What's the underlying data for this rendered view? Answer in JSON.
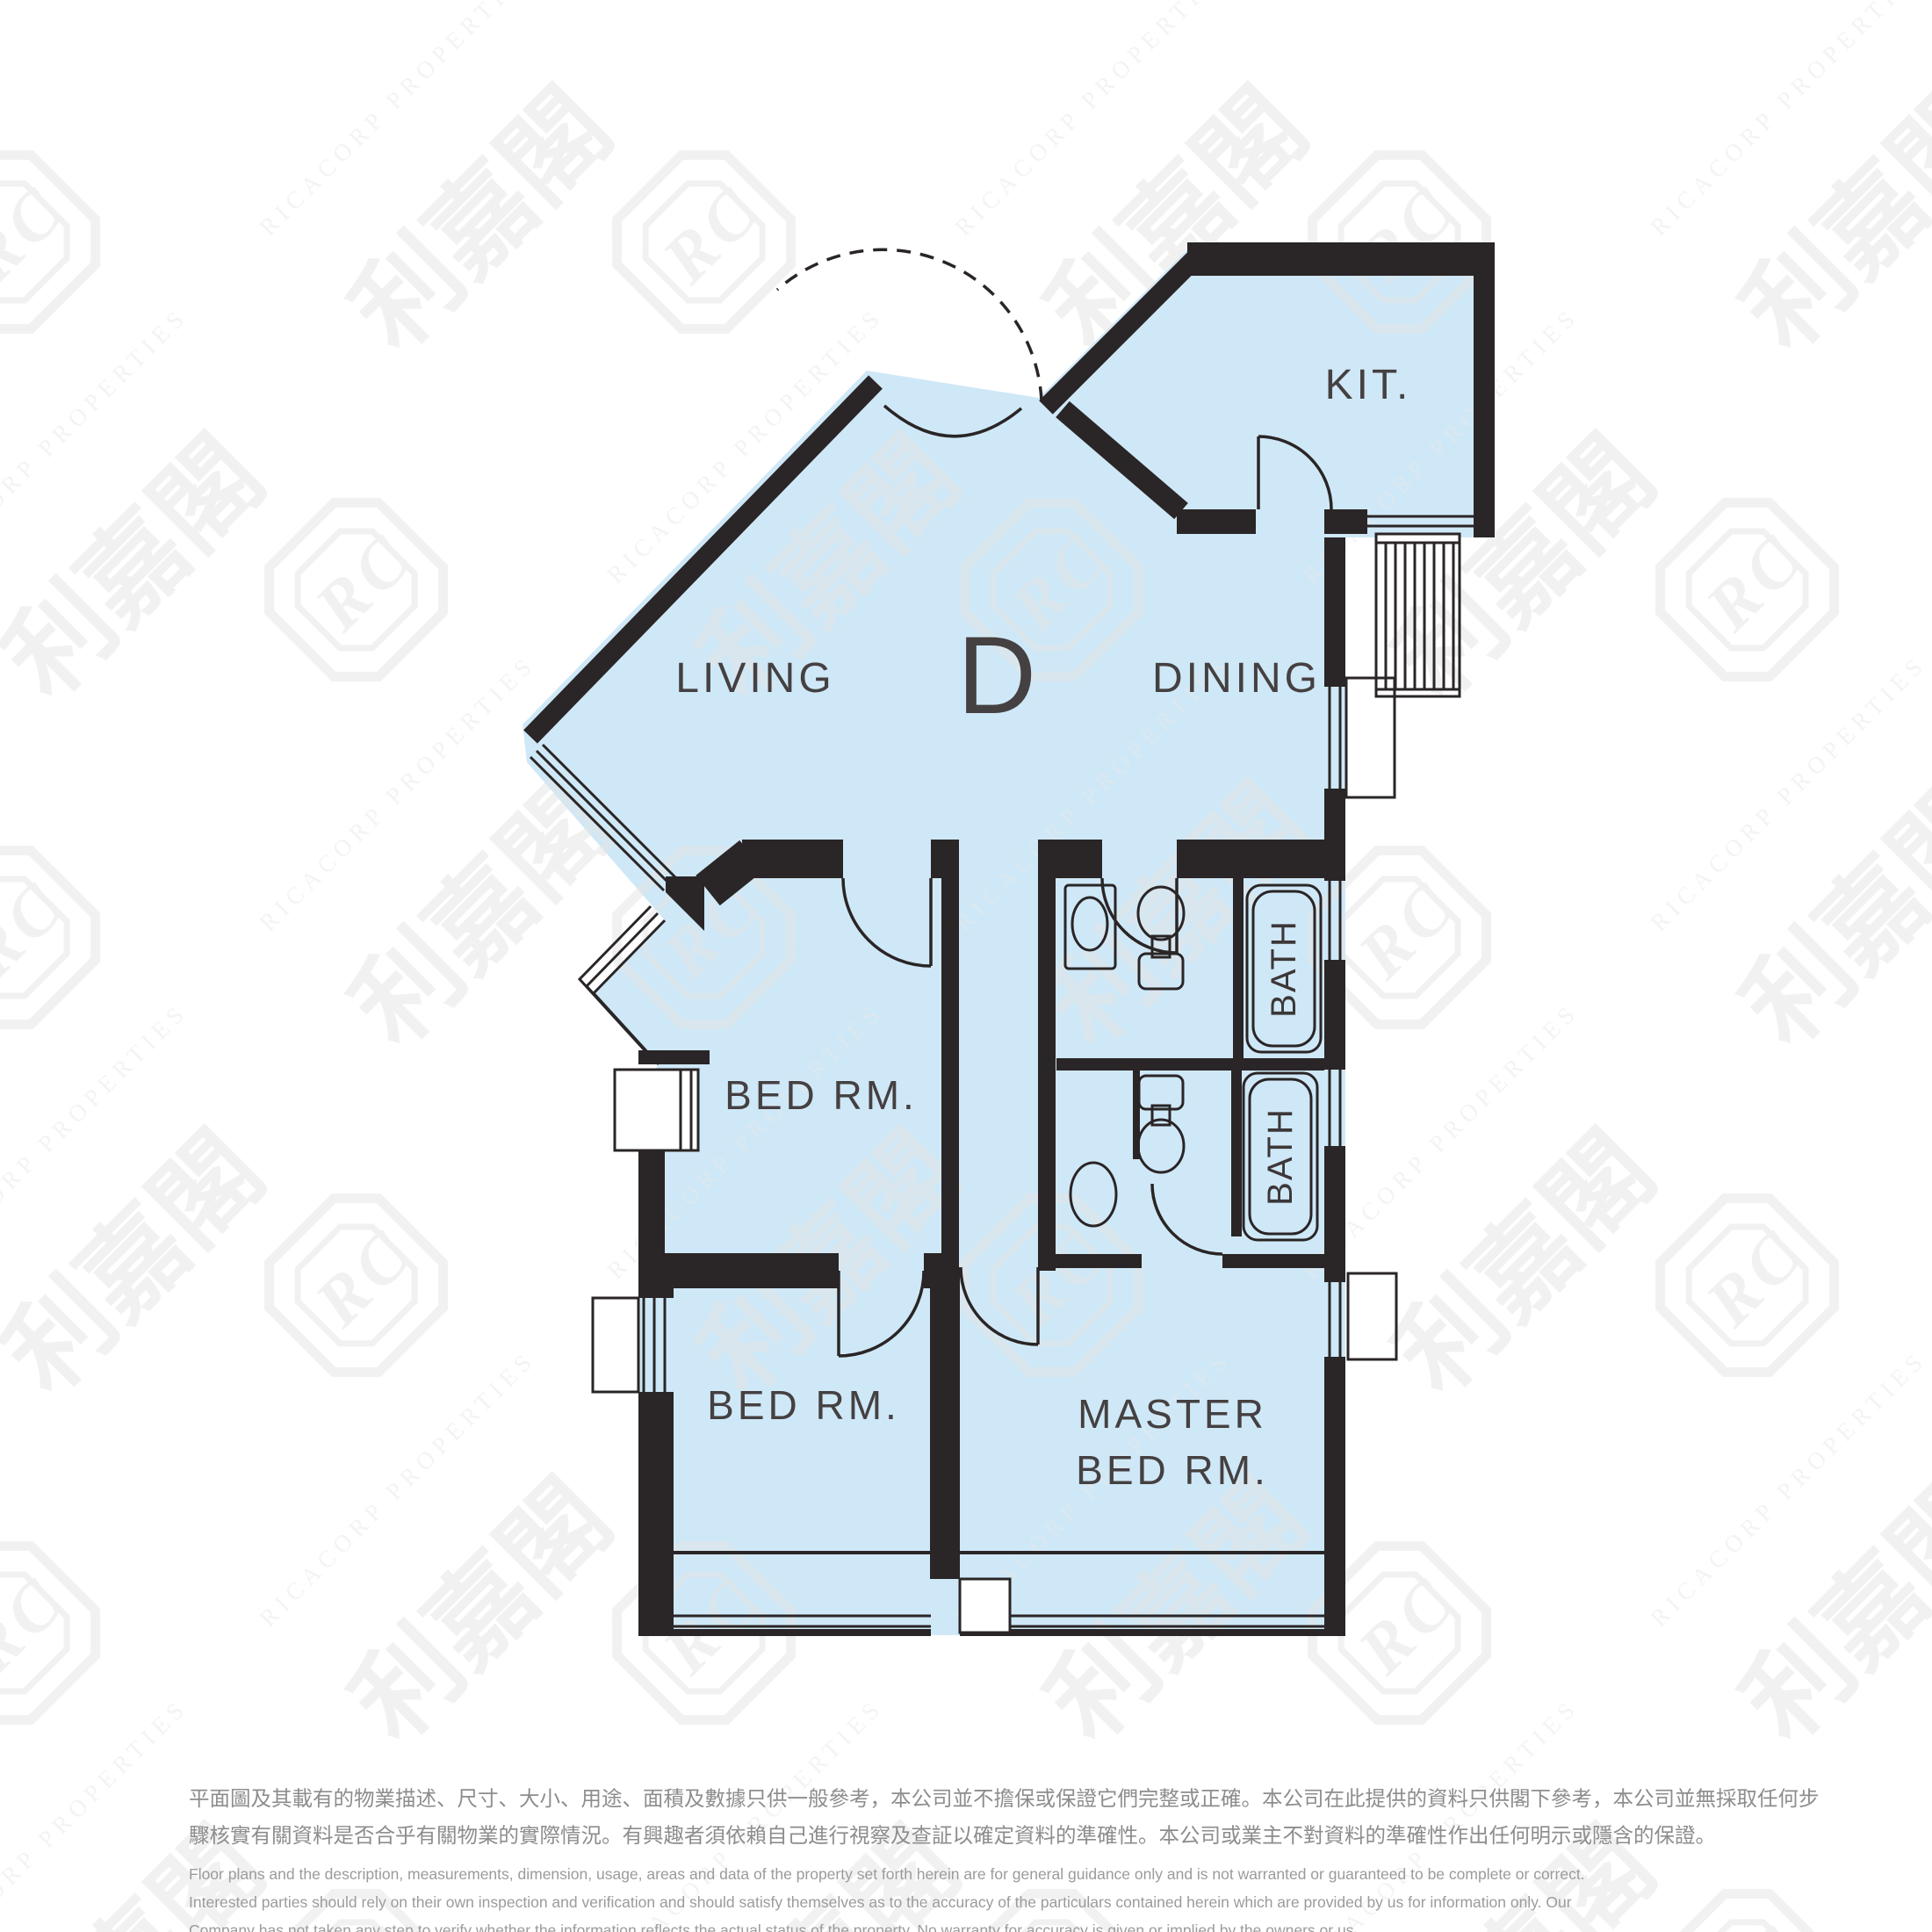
{
  "document": {
    "kind": "property-floor-plan",
    "unit_letter": "D"
  },
  "rooms": {
    "living": {
      "label": "LIVING"
    },
    "dining": {
      "label": "DINING"
    },
    "kitchen": {
      "label": "KIT."
    },
    "bedroom_mid": {
      "label": "BED RM."
    },
    "bedroom_left": {
      "label": "BED RM."
    },
    "master": {
      "line1": "MASTER",
      "line2": "BED RM."
    },
    "bath1": {
      "label": "BATH"
    },
    "bath2": {
      "label": "BATH"
    }
  },
  "watermark": {
    "chinese": "利嘉閣",
    "monogram": "RC",
    "english": "RICACORP PROPERTIES"
  },
  "disclaimer": {
    "chinese_line1": "平面圖及其載有的物業描述、尺寸、大小、用途、面積及數據只供一般參考，本公司並不擔保或保證它們完整或正確。本公司在此提供的資料只供閣下參考，本公司並無採取任何步",
    "chinese_line2": "驟核實有關資料是否合乎有關物業的實際情況。有興趣者須依賴自己進行視察及查証以確定資料的準確性。本公司或業主不對資料的準確性作出任何明示或隱含的保證。",
    "english_line1": "Floor plans and the description, measurements, dimension, usage, areas and data of the property set forth herein are for general guidance only and is not warranted or guaranteed to be complete or correct.",
    "english_line2": "Interested parties should rely on their own inspection and verification and should satisfy themselves as to the accuracy of the particulars contained herein which are provided by us for information only.  Our",
    "english_line3": "Company has not taken any step to verify whether the information reflects the actual status of the property.  No warranty for accuracy is given or implied by the owners or us."
  },
  "colors": {
    "floor_fill": "#cfe8f7",
    "wall": "#2a2526",
    "label_text": "#454041",
    "watermark": "#e3e3e3",
    "disclaimer_cjk": "#8d8d8d",
    "disclaimer_en": "#9b9b9b",
    "background": "#ffffff"
  }
}
